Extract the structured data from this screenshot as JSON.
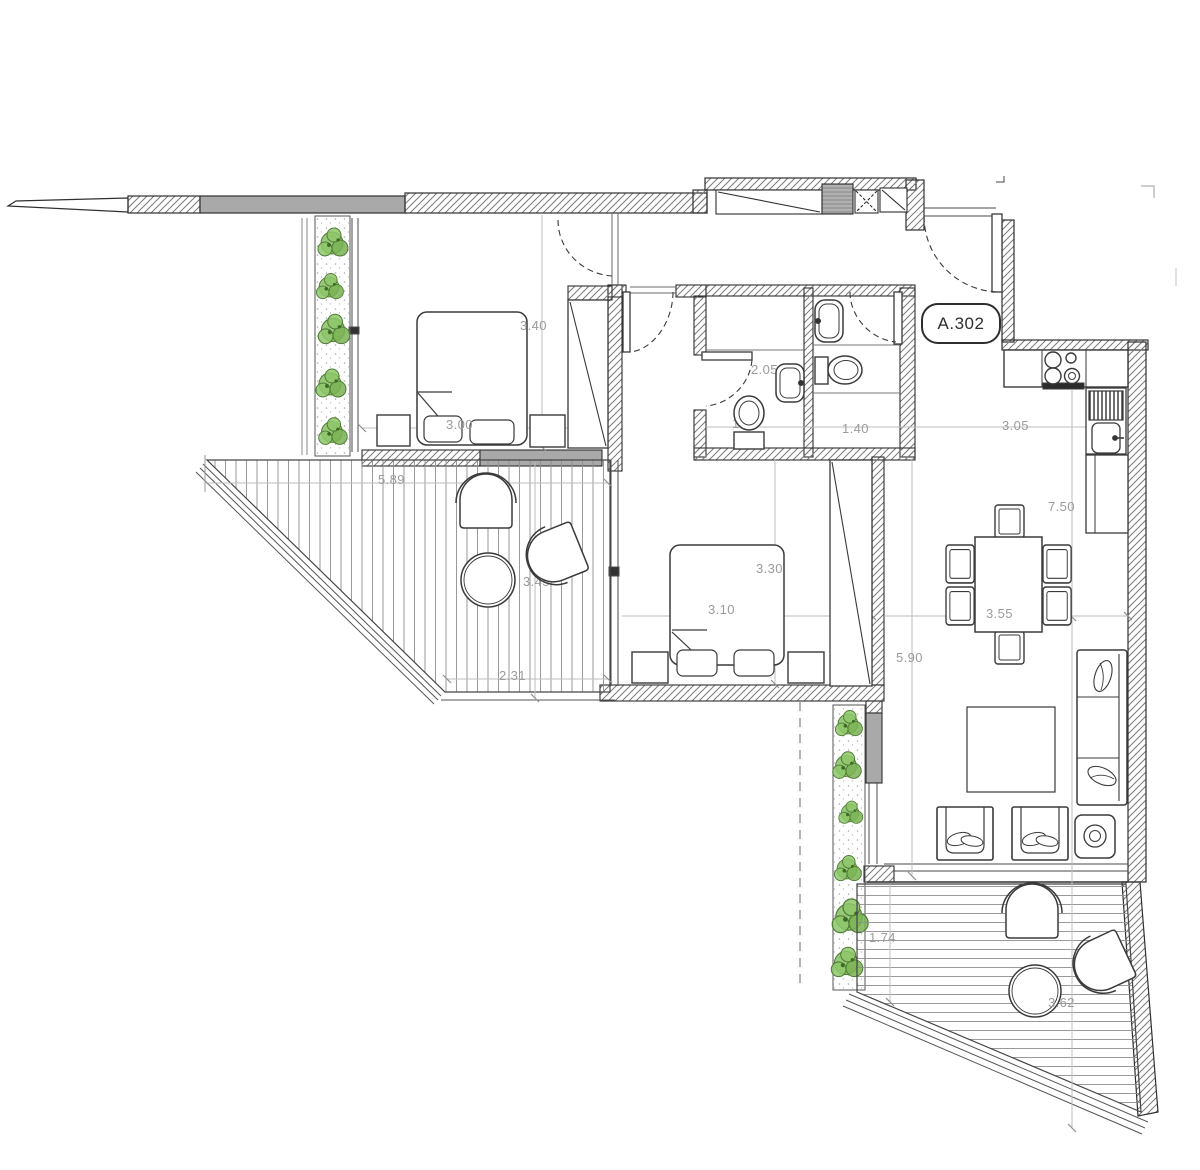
{
  "unit": {
    "badge": "A.302"
  },
  "dims": {
    "bedroom1_depth": "3.40",
    "bedroom1_bed": "3.00",
    "bath1_length": "2.05",
    "bath1_width": "1.20",
    "bath2_width": "1.40",
    "kitchen_width": "3.05",
    "right_wing_length": "7.50",
    "terrace1_top": "5.89",
    "terrace1_bottom": "2.31",
    "terrace1_depth": "3.45",
    "bedroom2_length": "3.30",
    "bedroom2_width": "3.10",
    "dining_width": "3.55",
    "living_length": "5.90",
    "terrace2_depth": "1.74",
    "terrace2_width": "3.62"
  },
  "colors": {
    "wall_line": "#2f2f2f",
    "hatch_line": "#7a7a7a",
    "gray_fill": "#a9a9a9",
    "plant_green": "#7cb45a",
    "dim_text": "#9b9b9b"
  }
}
